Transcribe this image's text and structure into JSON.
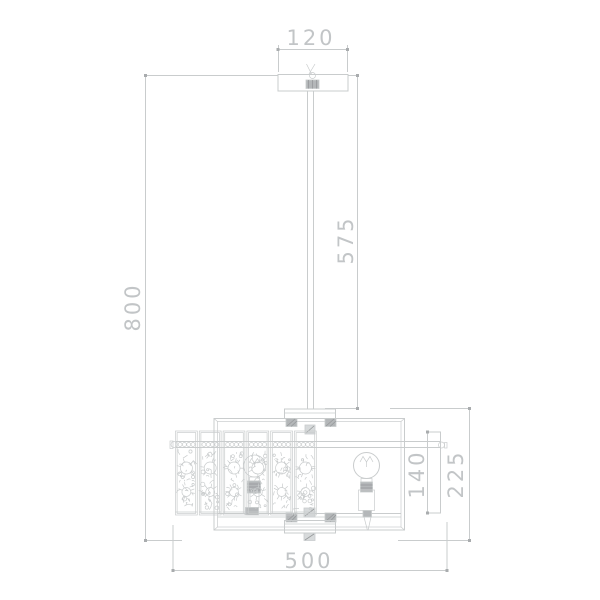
{
  "drawing": {
    "title": "Pendant lamp dimensional drawing",
    "dimensions": {
      "canopy_width": {
        "label": "120",
        "orientation": "horizontal"
      },
      "rod_drop": {
        "label": "575",
        "orientation": "vertical"
      },
      "overall_height": {
        "label": "800",
        "orientation": "vertical"
      },
      "shade_band_height": {
        "label": "140",
        "orientation": "vertical"
      },
      "body_height": {
        "label": "225",
        "orientation": "vertical"
      },
      "overall_width": {
        "label": "500",
        "orientation": "horizontal"
      }
    },
    "colors": {
      "background": "#ffffff",
      "line": "#c9cccd",
      "tick": "#a9acae",
      "text": "#c2c5c7",
      "hatch_fill": "#b4b7b9",
      "hatch_line": "#96999b",
      "light_fill": "#d7dadb"
    }
  }
}
